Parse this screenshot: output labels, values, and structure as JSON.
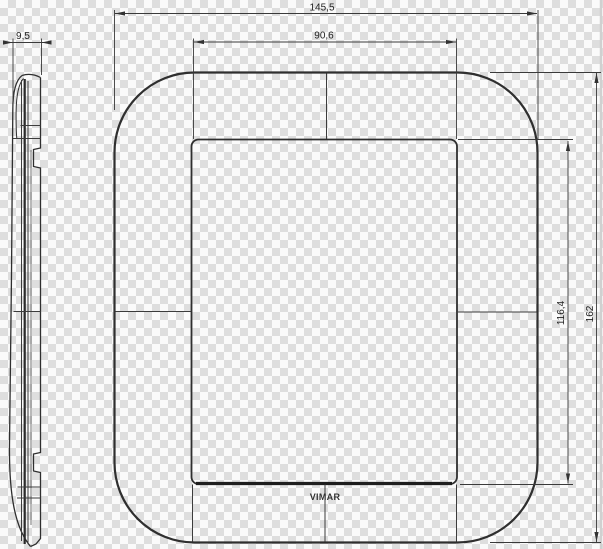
{
  "drawing": {
    "brand": "VIMAR",
    "dimensions": {
      "depth": "9,5",
      "overall_width": "145,5",
      "opening_width": "90,6",
      "opening_height": "116,4",
      "overall_height": "162"
    },
    "colors": {
      "line": "#2f2f2f",
      "dimension_line": "#3a3a3a",
      "checker_gray": "#dedede",
      "checker_white": "#fafafa"
    }
  }
}
